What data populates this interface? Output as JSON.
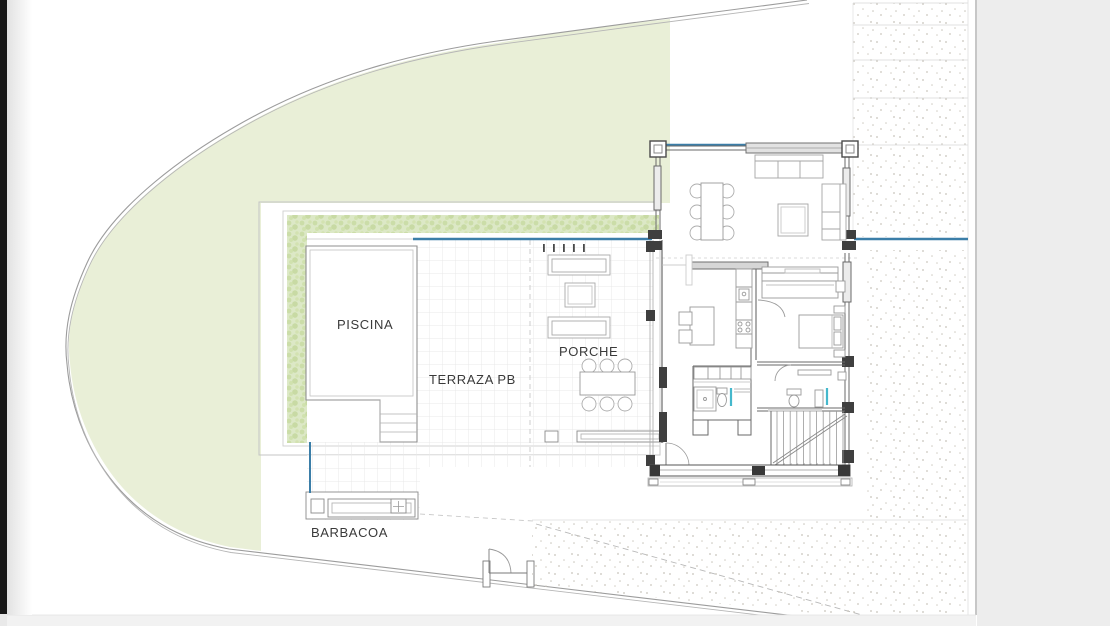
{
  "plan": {
    "labels": {
      "pool": "PISCINA",
      "terrace": "TERRAZA PB",
      "porch": "PORCHE",
      "barbecue": "BARBACOA"
    },
    "colors": {
      "lawn": "#e9efd7",
      "hedge_base": "#dce8c6",
      "water_line": "#3b7ea8",
      "fixture_accent": "#45b8cc",
      "paper_margin": "#ededed",
      "edge_bar": "#181818",
      "stipple_dot": "#c7c3ba"
    }
  }
}
